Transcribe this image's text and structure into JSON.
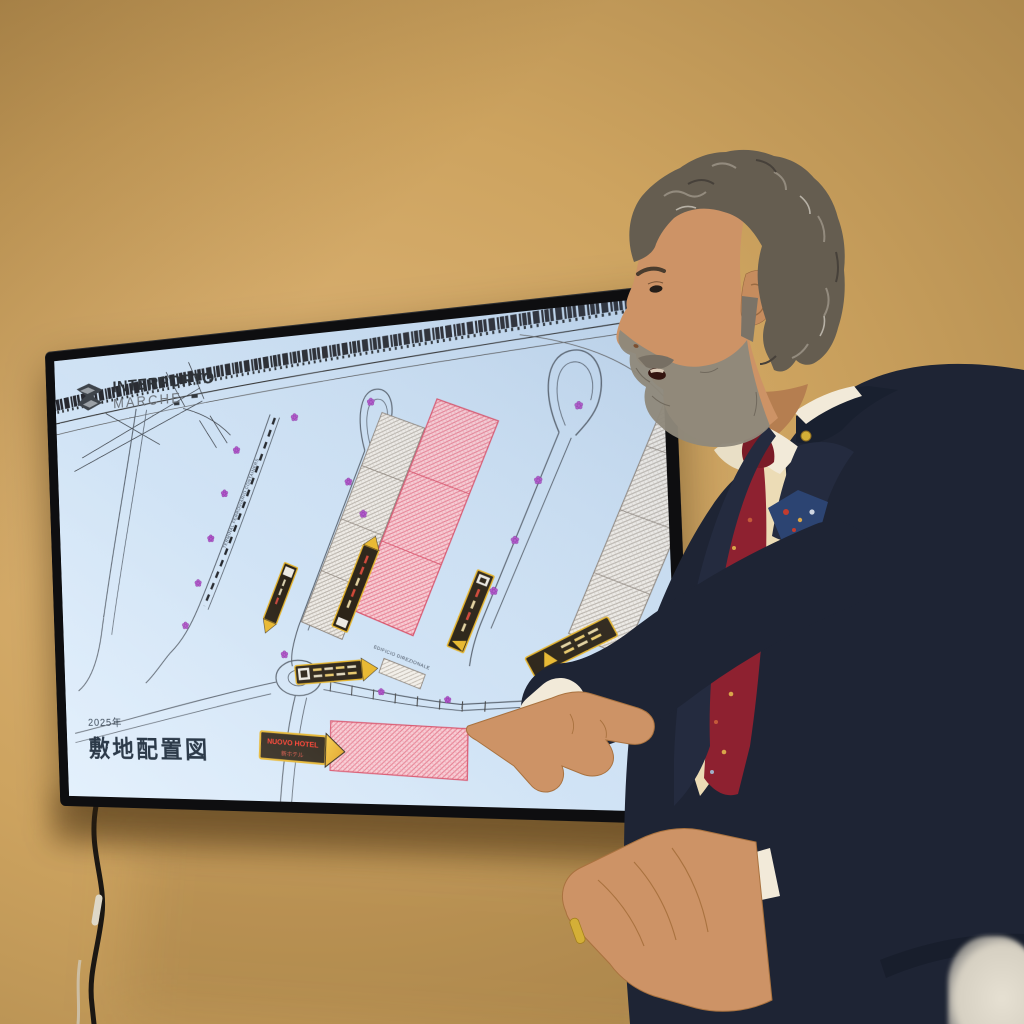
{
  "colors": {
    "wall": "#cda35f",
    "wall_dark": "#a9854b",
    "wall_light": "#ddb476",
    "tv_bezel": "#0e0e10",
    "screen_bg_1": "#d9eafb",
    "screen_bg_2": "#c2d8ee",
    "plan_line": "#5a6470",
    "railway_ink": "#17171c",
    "sign_body": "#2c2418",
    "sign_border": "#e5b42c",
    "marker_purple": "#b157cb",
    "logo_dark": "#2e3338",
    "logo_gray": "#6d737a",
    "title_ink": "#2c3a49",
    "suit_navy": "#1e2434",
    "lapel_navy": "#242b3f",
    "shirt_cream": "#ecdcb6",
    "collar_white": "#f2ead9",
    "tie_red": "#8e2130",
    "skin": "#cd9366",
    "hair_gray": "#655d50",
    "beard_gray": "#8f887b",
    "gold": "#d4af37",
    "hotel_text_red": "#ff3a2a"
  },
  "screen": {
    "logo": {
      "line1": "INTERPORTO",
      "line2": "MARCHE"
    },
    "caption": {
      "year": "2025年",
      "title": "敷地配置図"
    },
    "labels": {
      "terminal_road": "TERMINAL FERROVIARIO CONTAINERS",
      "edificio": "EDIFICIO DIREZIONALE"
    },
    "hotel_sign": {
      "line1": "NUOVO HOTEL",
      "line2": "新ホテル"
    }
  }
}
